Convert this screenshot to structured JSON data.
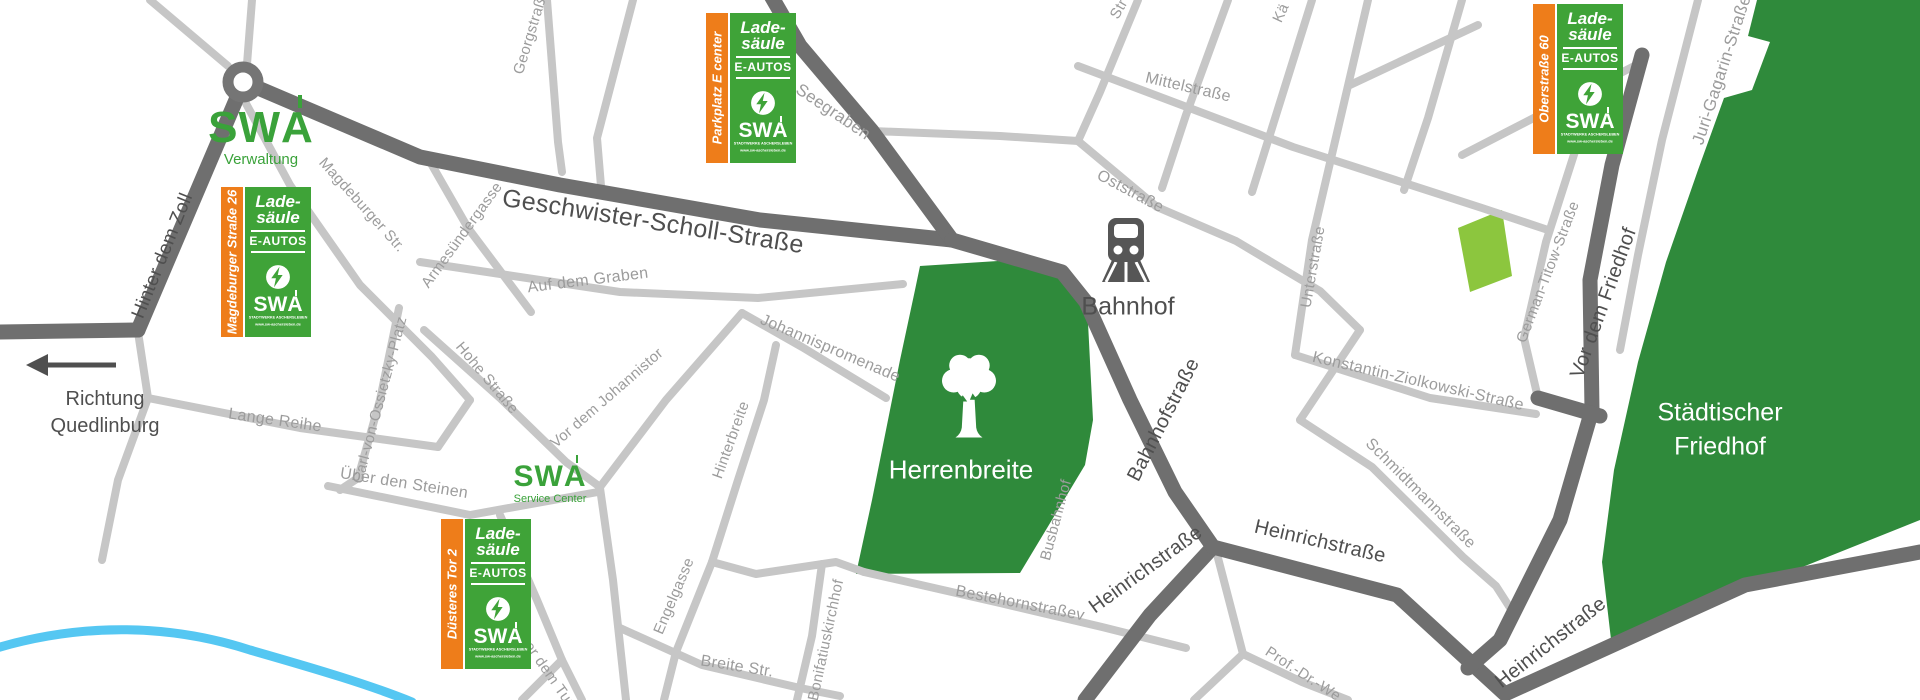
{
  "colors": {
    "park_green": "#2f8a3b",
    "badge_green": "#3fa338",
    "logo_green": "#3aa23a",
    "badge_orange": "#ee7d1a",
    "road_major": "#6f6f6f",
    "road_minor": "#c6c6c6",
    "water_blue": "#55c7f2",
    "label_minor": "#9c9c9c",
    "label_major": "#4f4f4f",
    "light_green": "#8cc63e"
  },
  "badges": {
    "product_line1": "Lade-",
    "product_line2": "säule",
    "vehicle": "E-AUTOS",
    "brand_sw": "SW",
    "brand_a": "A",
    "brand_sub1": "STADTWERKE ASCHERSLEBEN",
    "brand_sub2": "www.sw-aschersleben.de",
    "items": [
      {
        "street": "Parkplatz E center"
      },
      {
        "street": "Magdeburger Straße 26"
      },
      {
        "street": "Oberstraße 60"
      },
      {
        "street": "Düsteres Tor 2"
      }
    ]
  },
  "logos": {
    "brand_sw": "SW",
    "brand_a": "A",
    "verwaltung": "Verwaltung",
    "service_center": "Service Center"
  },
  "pois": {
    "station": "Bahnhof",
    "park": "Herrenbreite",
    "cemetery_line1": "Städtischer",
    "cemetery_line2": "Friedhof"
  },
  "direction": {
    "line1": "Richtung",
    "line2": "Quedlinburg"
  },
  "streets": [
    {
      "t": "Hinter dem Zoll",
      "x": 163,
      "y": 256,
      "r": -68,
      "s": 19,
      "c": "maj"
    },
    {
      "t": "Magdeburger Str.",
      "x": 362,
      "y": 205,
      "r": 48,
      "s": 15,
      "c": "min"
    },
    {
      "t": "Georgstraße",
      "x": 531,
      "y": 32,
      "r": -73,
      "s": 15,
      "c": "min"
    },
    {
      "t": "Geschwister-Scholl-Straße",
      "x": 653,
      "y": 222,
      "r": 9,
      "s": 25,
      "c": "maj"
    },
    {
      "t": "Seegraben",
      "x": 833,
      "y": 112,
      "r": 34,
      "s": 17,
      "c": "min"
    },
    {
      "t": "Armesündergasse",
      "x": 462,
      "y": 235,
      "r": -54,
      "s": 15,
      "c": "min"
    },
    {
      "t": "Auf dem Graben",
      "x": 588,
      "y": 281,
      "r": -7,
      "s": 16,
      "c": "min"
    },
    {
      "t": "Johannispromenade",
      "x": 830,
      "y": 349,
      "r": 23,
      "s": 16,
      "c": "min"
    },
    {
      "t": "Hinterbreite",
      "x": 731,
      "y": 440,
      "r": -70,
      "s": 15,
      "c": "min"
    },
    {
      "t": "Carl-von-Ossietzky-Platz",
      "x": 380,
      "y": 400,
      "r": -75,
      "s": 15,
      "c": "min"
    },
    {
      "t": "Hohe Straße",
      "x": 487,
      "y": 378,
      "r": 50,
      "s": 15,
      "c": "min"
    },
    {
      "t": "Vor dem Johannistor",
      "x": 607,
      "y": 398,
      "r": -41,
      "s": 15,
      "c": "min"
    },
    {
      "t": "Lange Reihe",
      "x": 275,
      "y": 421,
      "r": 8,
      "s": 16,
      "c": "min"
    },
    {
      "t": "Über den Steinen",
      "x": 404,
      "y": 484,
      "r": 9,
      "s": 16,
      "c": "min"
    },
    {
      "t": "Hinter dem Turm",
      "x": 545,
      "y": 668,
      "r": 55,
      "s": 15,
      "c": "min"
    },
    {
      "t": "Engelgasse",
      "x": 674,
      "y": 596,
      "r": -67,
      "s": 15,
      "c": "min"
    },
    {
      "t": "Breite Str.",
      "x": 737,
      "y": 667,
      "r": 9,
      "s": 16,
      "c": "min"
    },
    {
      "t": "Bonifatiuskirchhof",
      "x": 826,
      "y": 640,
      "r": -78,
      "s": 15,
      "c": "min"
    },
    {
      "t": "Bestehornstraßev",
      "x": 1020,
      "y": 604,
      "r": 11,
      "s": 16,
      "c": "min"
    },
    {
      "t": "Busbahnhof",
      "x": 1056,
      "y": 520,
      "r": -75,
      "s": 15,
      "c": "min"
    },
    {
      "t": "Bahnhofstraße",
      "x": 1164,
      "y": 420,
      "r": -63,
      "s": 20,
      "c": "maj"
    },
    {
      "t": "Heinrichstraße",
      "x": 1146,
      "y": 570,
      "r": -36,
      "s": 20,
      "c": "maj"
    },
    {
      "t": "Heinrichstraße",
      "x": 1320,
      "y": 542,
      "r": 13,
      "s": 20,
      "c": "maj"
    },
    {
      "t": "Heinrichstraße",
      "x": 1551,
      "y": 643,
      "r": -38,
      "s": 20,
      "c": "maj"
    },
    {
      "t": "Prof.-Dr.-We",
      "x": 1303,
      "y": 674,
      "r": 33,
      "s": 15,
      "c": "min"
    },
    {
      "t": "Mittelstraße",
      "x": 1188,
      "y": 88,
      "r": 13,
      "s": 16,
      "c": "min"
    },
    {
      "t": "Oststraße",
      "x": 1130,
      "y": 192,
      "r": 28,
      "s": 16,
      "c": "min"
    },
    {
      "t": "Unterstraße",
      "x": 1313,
      "y": 267,
      "r": -80,
      "s": 15,
      "c": "min"
    },
    {
      "t": "Konstantin-Ziolkowski-Straße",
      "x": 1418,
      "y": 382,
      "r": 13,
      "s": 16,
      "c": "min"
    },
    {
      "t": "Schmidtmannstraße",
      "x": 1420,
      "y": 494,
      "r": 45,
      "s": 16,
      "c": "min"
    },
    {
      "t": "German-Titow-Straße",
      "x": 1548,
      "y": 272,
      "r": -69,
      "s": 15,
      "c": "min"
    },
    {
      "t": "Vor dem Friedhof",
      "x": 1604,
      "y": 303,
      "r": -70,
      "s": 20,
      "c": "maj"
    },
    {
      "t": "Juri-Gagarin-Straße",
      "x": 1722,
      "y": 70,
      "r": -72,
      "s": 17,
      "c": "min"
    },
    {
      "t": "Kä",
      "x": 1281,
      "y": 13,
      "r": -65,
      "s": 15,
      "c": "min"
    },
    {
      "t": "Str",
      "x": 1119,
      "y": 9,
      "r": -60,
      "s": 15,
      "c": "min"
    }
  ]
}
